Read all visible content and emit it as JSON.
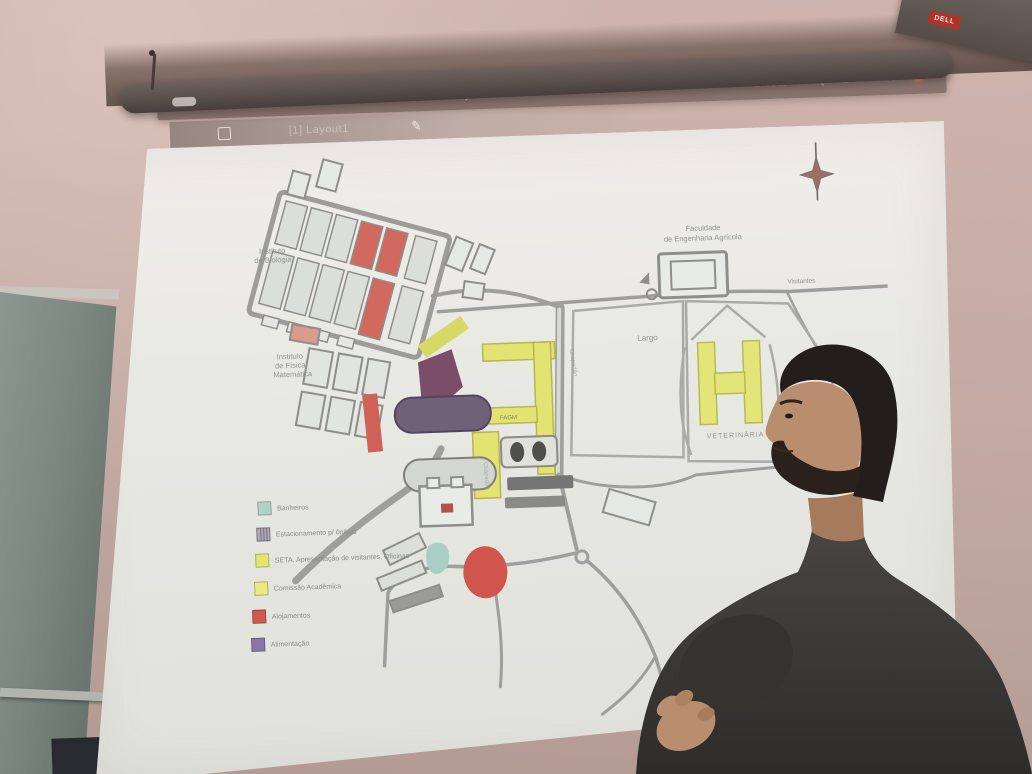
{
  "scene": {
    "type": "photograph",
    "description": "A presenter stands in profile before a pull-down projector screen showing a CAD campus map (AutoCAD Layout1 view) with a colored legend; a chalkboard is at left.",
    "colors": {
      "wall": "#cdb3ac",
      "chalkboard": "#7d8983",
      "screen_white": "#eceae5",
      "screen_case": "#594f4b",
      "projected_bar": "#8b7672",
      "sweater": "#3b3a38",
      "skin": "#b98e6f",
      "hair": "#241f1b"
    }
  },
  "projected_app": {
    "title_bar": {
      "title": "Layout1",
      "zoom_level": "17.0%",
      "icons": [
        "caret-down-icon",
        "magnifier-icon",
        "menu-icon",
        "minus-icon",
        "plus-icon",
        "close-dot-icon"
      ]
    },
    "tab_bar": {
      "active_tab": "[1] Layout1",
      "icons": [
        "layout-square-icon",
        "pencil-icon"
      ]
    }
  },
  "map": {
    "labels": {
      "instituto_biologia": {
        "lines": [
          "Instituto",
          "de Biologia"
        ]
      },
      "instituto_fisica": {
        "lines": [
          "Instituto",
          "de Física",
          "Matemática"
        ]
      },
      "feagri": {
        "lines": [
          "Faculdade",
          "de Engenharia Agrícola"
        ]
      },
      "largo": "Largo",
      "veterinaria": "VETERINÁRIA",
      "visitantes": "Visitantes",
      "chapadao": "Chapadão",
      "fagm": "FAGM"
    },
    "legend": {
      "items": [
        {
          "label": "Banheiros",
          "color": "#aed3c6"
        },
        {
          "label": "Estacionamento p/ ônibus",
          "color": "#b0a7b4"
        },
        {
          "label": "SETA, Apresentação de visitantes, Oficinas",
          "color": "#e3e56e"
        },
        {
          "label": "Comissão Acadêmica",
          "color": "#eceb7d"
        },
        {
          "label": "Alojamentos",
          "color": "#cf5a52"
        },
        {
          "label": "Alimentação",
          "color": "#8677a8"
        }
      ]
    }
  },
  "hardware": {
    "screen_brand_label": "DELL"
  }
}
